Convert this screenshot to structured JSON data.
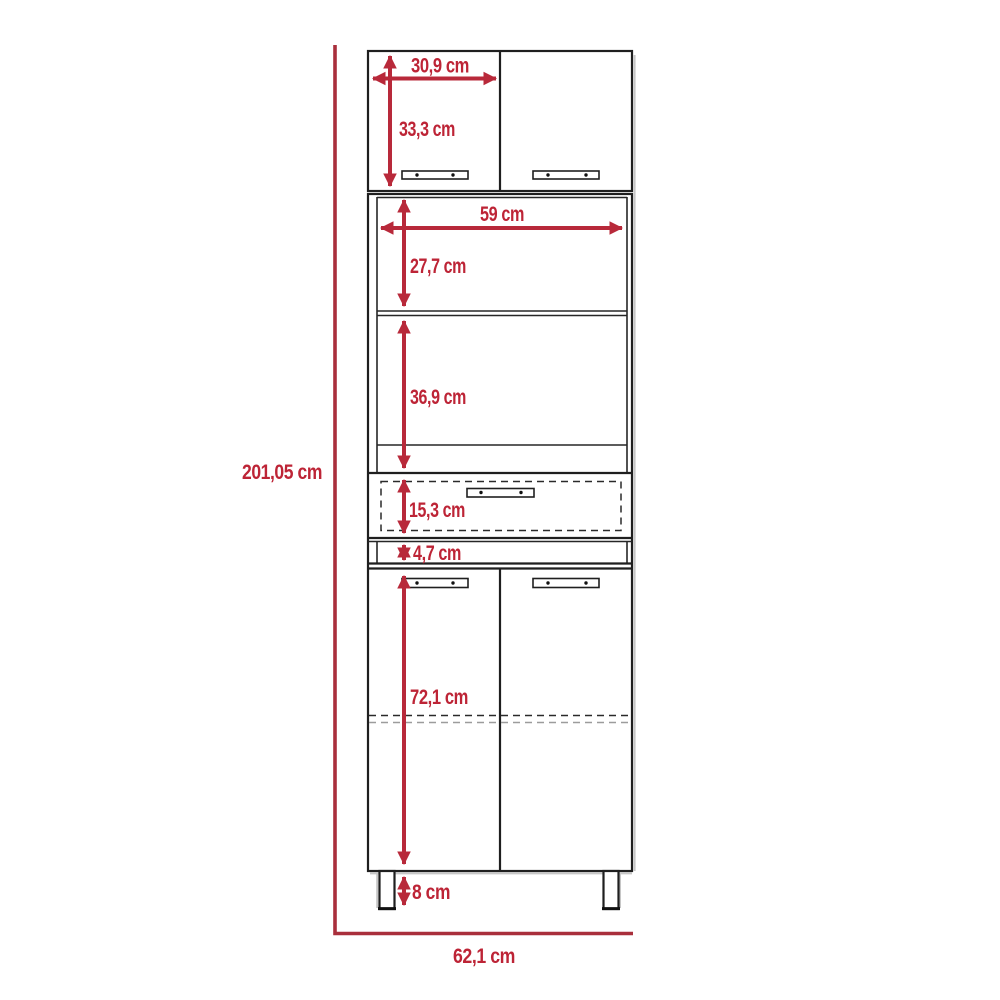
{
  "diagram": {
    "kind": "furniture-dimension-drawing",
    "subject": "tall kitchen pantry cabinet, front elevation with dimensions",
    "units": "cm",
    "colors": {
      "dimension_accent": "#b8293a",
      "cabinet_outline": "#1f1f1f",
      "shadow_gray": "#c6c6c6",
      "background": "#ffffff"
    },
    "dimensions": {
      "overall_height": "201,05 cm",
      "overall_width": "62,1 cm",
      "top_door_width": "30,9 cm",
      "top_section_height": "33,3 cm",
      "inner_width": "59 cm",
      "upper_opening_height": "27,7 cm",
      "lower_opening_height": "36,9 cm",
      "drawer_height": "15,3 cm",
      "rail_height": "4,7 cm",
      "bottom_door_height": "72,1 cm",
      "leg_height": "8 cm"
    }
  }
}
